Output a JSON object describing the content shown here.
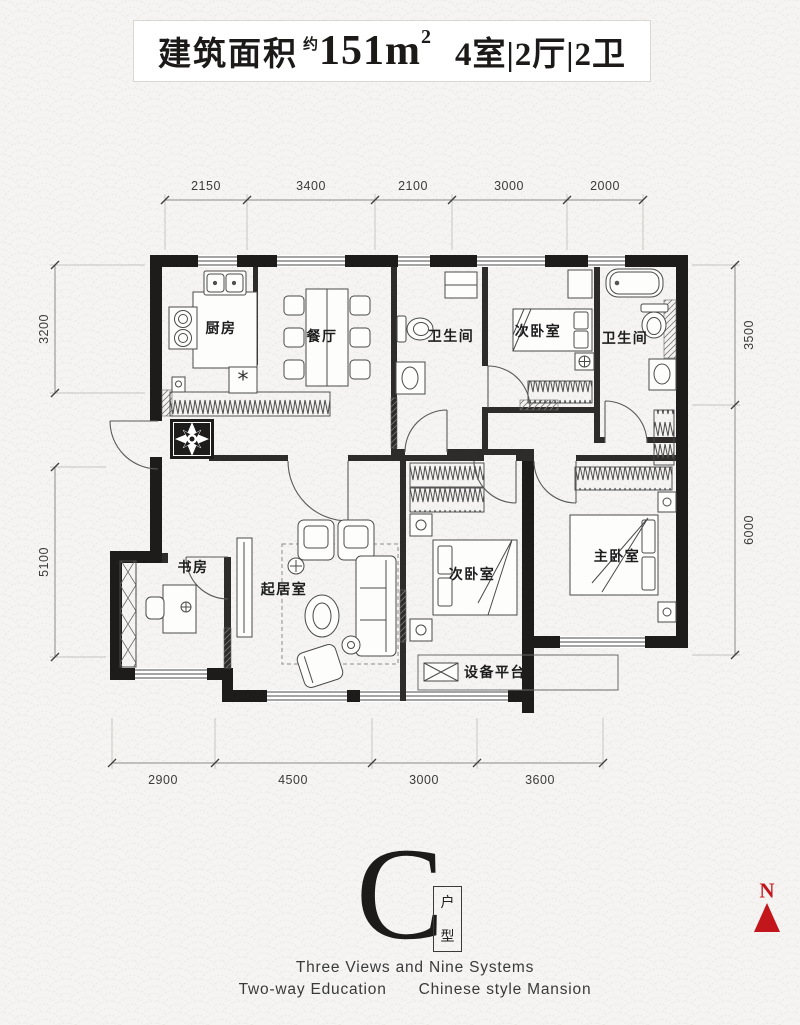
{
  "title": {
    "prefix": "建筑面积",
    "approx": "约",
    "area": "151m",
    "area_sup": "2",
    "layout": "4室|2厅|2卫"
  },
  "dimensions": {
    "top": [
      "2150",
      "3400",
      "2100",
      "3000",
      "2000"
    ],
    "bottom": [
      "2900",
      "4500",
      "3000",
      "3600"
    ],
    "left": [
      "3200",
      "5100"
    ],
    "right": [
      "3500",
      "6000"
    ]
  },
  "rooms": {
    "kitchen": "厨房",
    "dining": "餐厅",
    "bath1": "卫生间",
    "bed_top": "次卧室",
    "bath2": "卫生间",
    "study": "书房",
    "living": "起居室",
    "bed_bottom": "次卧室",
    "master": "主卧室",
    "platform": "设备平台"
  },
  "logo": {
    "letter": "C",
    "unit_top": "户",
    "unit_bottom": "型"
  },
  "slogan": {
    "line1": "Three Views and Nine Systems",
    "line2_left": "Two-way Education",
    "line2_right": "Chinese style Mansion"
  },
  "compass": {
    "north": "N"
  },
  "colors": {
    "wall": "#1e1c1a",
    "accent_red": "#c3161c",
    "line": "#555555",
    "background": "#f4f3f1",
    "pattern": "#eae8e5"
  }
}
